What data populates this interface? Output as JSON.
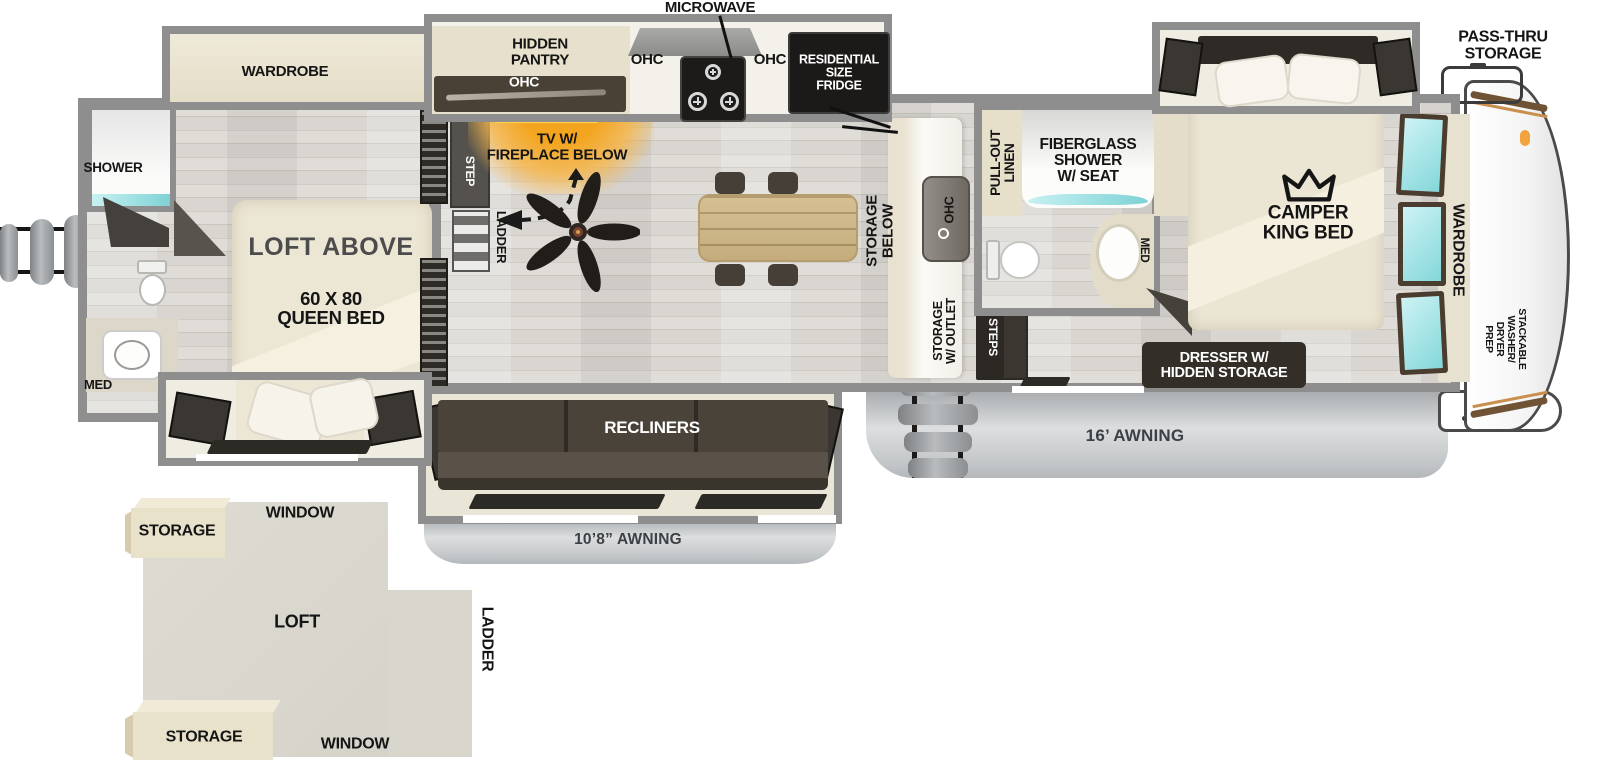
{
  "palette": {
    "wall_gray": "#8e8e8e",
    "floor_wood": "#d7d4cf",
    "cabinet_dark": "#332e27",
    "beige": "#e8e2d0",
    "teal_glass": "#8fdfe2",
    "awning_gray": "#c2c5c7",
    "tv_glow_orange": "#f2a62b",
    "label_black": "#151515",
    "label_white": "#ffffff"
  },
  "exterior": {
    "pass_thru_storage": "PASS-THRU\nSTORAGE",
    "awning_right": "16’ AWNING",
    "awning_left": "10’8” AWNING"
  },
  "kitchen": {
    "microwave": "MICROWAVE",
    "hidden_pantry": "HIDDEN\nPANTRY",
    "pantry_ohc": "OHC",
    "ohc_left": "OHC",
    "ohc_right": "OHC",
    "fridge": "RESIDENTIAL\nSIZE\nFRIDGE"
  },
  "living": {
    "tv_fireplace": "TV W/\nFIREPLACE BELOW",
    "step": "STEP",
    "ladder": "LADDER",
    "storage_below": "STORAGE\nBELOW",
    "island_ohc": "OHC",
    "storage_outlet": "STORAGE\nW/ OUTLET",
    "steps": "STEPS",
    "recliners": "RECLINERS"
  },
  "bathroom": {
    "pull_out_linen": "PULL-OUT\nLINEN",
    "fiberglass_shower": "FIBERGLASS\nSHOWER\nW/ SEAT",
    "med": "MED"
  },
  "bedroom": {
    "camper_king_bed": "CAMPER\nKING BED",
    "dresser": "DRESSER W/\nHIDDEN STORAGE",
    "wardrobe": "WARDROBE",
    "washer_prep": "STACKABLE\nWASHER/\nDRYER\nPREP"
  },
  "rear_suite": {
    "wardrobe": "WARDROBE",
    "shower": "SHOWER",
    "loft_above": "LOFT ABOVE",
    "queen_bed": "60 X 80\nQUEEN BED",
    "med": "MED"
  },
  "loft_inset": {
    "storage_top": "STORAGE",
    "window_top": "WINDOW",
    "loft": "LOFT",
    "ladder": "LADDER",
    "window_bottom": "WINDOW",
    "storage_bottom": "STORAGE"
  }
}
